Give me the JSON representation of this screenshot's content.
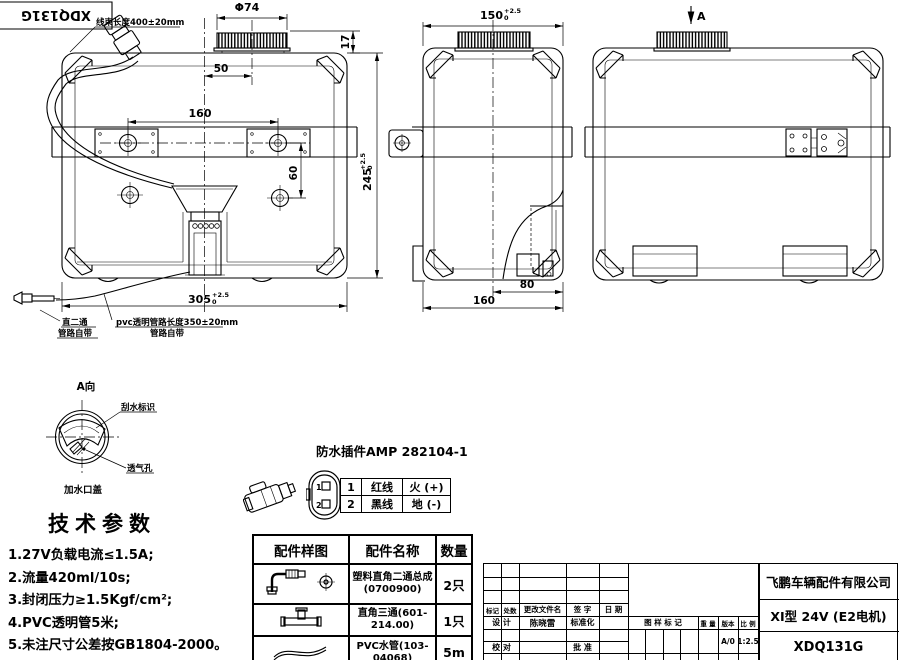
{
  "stamp": {
    "code": "XDQ131G"
  },
  "front_view": {
    "harness_label": "线束长度400±20mm",
    "dim_cap_dia": "Φ74",
    "dim_cap_offset": "50",
    "dim_holes_h": "160",
    "dim_holes_v": "60",
    "dim_cap_height": "17",
    "dim_width": "305",
    "dim_width_tol_up": "+2.5",
    "dim_width_tol_low": "0",
    "dim_height": "245",
    "dim_height_tol_up": "+2.5",
    "dim_height_tol_low": "0",
    "fitting_line1": "直二通",
    "fitting_line2": "管路自带",
    "pipe_line1": "pvc透明管路长度350±20mm",
    "pipe_line2": "管路自带"
  },
  "side_view": {
    "dim_depth": "150",
    "dim_depth_tol_up": "+2.5",
    "dim_depth_tol_low": "0",
    "dim_80": "80",
    "dim_160": "160"
  },
  "rear_view": {
    "view_label": "A"
  },
  "detail_a": {
    "title": "A向",
    "wiper_label": "刮水标识",
    "vent_label": "透气孔",
    "cap_label": "加水口盖"
  },
  "tech_params": {
    "title": "技术参数",
    "items": [
      "1.27V负载电流≤1.5A;",
      "2.流量420ml/10s;",
      "3.封闭压力≥1.5Kgf/cm²;",
      "4.PVC透明管5米;",
      "5.未注尺寸公差按GB1804-2000。"
    ]
  },
  "connector": {
    "title": "防水插件AMP 282104-1",
    "pin1": {
      "no": "1",
      "wire": "红线",
      "signal": "火 (+)"
    },
    "pin2": {
      "no": "2",
      "wire": "黑线",
      "signal": "地 (-)"
    }
  },
  "parts_table": {
    "col_sample": "配件样图",
    "col_name": "配件名称",
    "col_qty": "数量",
    "rows": [
      {
        "name1": "塑料直角二通总成",
        "name2": "(0700900)",
        "qty": "2只"
      },
      {
        "name1": "直角三通(601-214.00)",
        "name2": "",
        "qty": "1只"
      },
      {
        "name1": "PVC水管(103-04068)",
        "name2": "",
        "qty": "5m"
      }
    ]
  },
  "title_block": {
    "company": "飞鹏车辆配件有限公司",
    "model": "XI型 24V (E2电机)",
    "drawing_no": "XDQ131G",
    "col_mark": "标记",
    "col_count": "处数",
    "col_doc": "更改文件名",
    "col_sign": "签 字",
    "col_date": "日 期",
    "row_design": "设 计",
    "designer": "陈晓雷",
    "row_std": "标准化",
    "row_check": "校 对",
    "row_approve": "批 准",
    "drawing_mark": "图 样 标 记",
    "weight": "重 量",
    "version_label": "版本",
    "scale_label": "比 例",
    "version": "A/0",
    "scale": "1:2.5"
  }
}
